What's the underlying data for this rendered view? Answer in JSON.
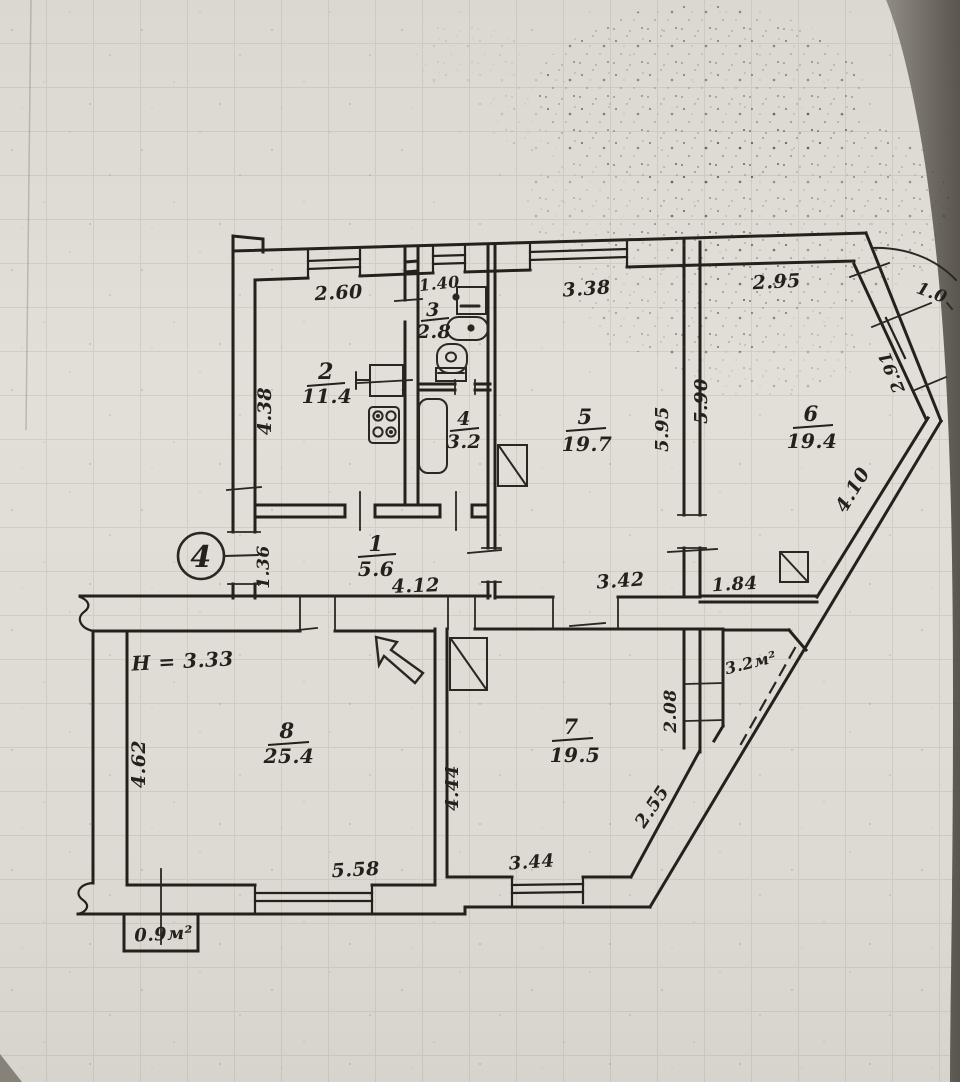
{
  "title": "Hand-drawn apartment floor plan (BTI scheme)",
  "apartment": {
    "circle_number": "4",
    "ceiling_height_note": "H = 3.33"
  },
  "rooms": [
    {
      "number": "1",
      "area": "5.6"
    },
    {
      "number": "2",
      "area": "11.4"
    },
    {
      "number": "3",
      "area": "2.8"
    },
    {
      "number": "4",
      "area": "3.2"
    },
    {
      "number": "5",
      "area": "19.7"
    },
    {
      "number": "6",
      "area": "19.4"
    },
    {
      "number": "7",
      "area": "19.5"
    },
    {
      "number": "8",
      "area": "25.4"
    }
  ],
  "dims": {
    "room2_top": "2.60",
    "room3_top": "1.40",
    "room5_top": "3.38",
    "room6_top": "2.95",
    "ne_wall_a": "1.0",
    "ne_wall_b": "2.91",
    "se_wall": "4.10",
    "room2_left": "4.38",
    "wall56_left": "5.95",
    "wall56_right": "5.90",
    "hall_left": "1.36",
    "hall_bottom": "4.12",
    "room5_bottom": "3.42",
    "room6_bottom": "1.84",
    "room8_left": "4.62",
    "room8_bottom": "5.58",
    "room7_left": "4.44",
    "room7_bottom": "3.44",
    "room7_diag": "2.55",
    "balcony_side": "2.08"
  },
  "balconies": {
    "loggia_area": "3.2м²",
    "small_balcony_area": "0.9м²"
  }
}
